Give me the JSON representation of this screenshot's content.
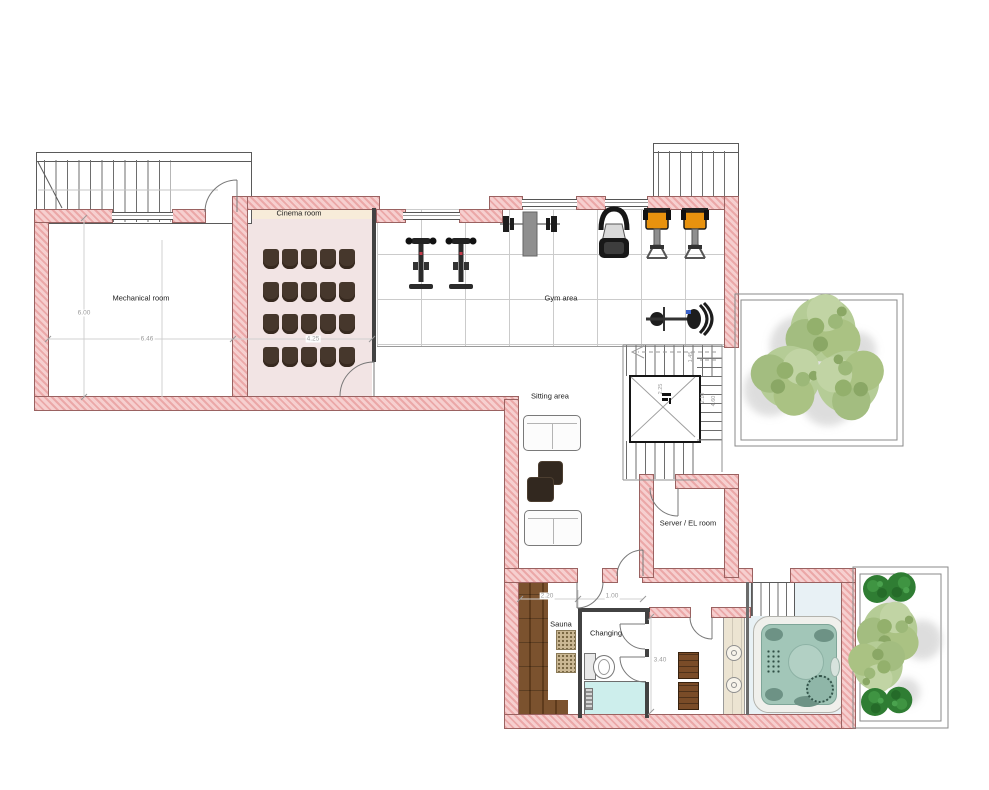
{
  "plan_type": "floor plan",
  "rooms": {
    "mechanical": {
      "label": "Mechanical room"
    },
    "cinema": {
      "label": "Cinema room"
    },
    "gym": {
      "label": "Gym area"
    },
    "sitting": {
      "label": "Sitting area"
    },
    "server_el": {
      "label": "Server / EL room"
    },
    "sauna": {
      "label": "Sauna"
    },
    "changing": {
      "label": "Changing"
    }
  },
  "dimensions": {
    "mechanical_height": "6.00",
    "mechanical_width": "6.46",
    "cinema_width": "4.25",
    "sauna_width": "2.20",
    "corridor_width": "1.00",
    "changing_depth": "3.40",
    "stair_run": "1.45",
    "elevator_width": "2.25",
    "stair_width": "2.10",
    "stairwell_depth": "4.60"
  },
  "cinema_seating": {
    "rows": 4,
    "cols": 5
  },
  "furniture_counts": {
    "sofas": 2,
    "ottomans": 2,
    "sauna_heaters": 2,
    "cabinets": 2
  },
  "gym_equipment": [
    "spin bike",
    "spin bike",
    "bench press",
    "cardio machine",
    "weight bench",
    "weight bench",
    "exercise bike"
  ],
  "features": [
    "elevator",
    "staircases",
    "hot tub",
    "toilet",
    "shower",
    "courtyard trees",
    "planter trees"
  ],
  "colors": {
    "wall_fill": "#f6cfcf",
    "wall_hatch": "#eba8a8",
    "cinema_floor": "#f2e4e4",
    "cinema_accent_strip": "#f7ecd9",
    "seat_brown": "#46372c",
    "sauna_wood": "#7b522e",
    "shower_blue": "#cdeeec",
    "hot_tub_teal": "#a2c6b8",
    "hot_tub_floor": "#e8f1f5",
    "tree_light_green": "#b5cc96",
    "tree_dark_green": "#2f7d33",
    "machine_orange": "#e8920e",
    "dimension_gray": "#9b9b9b"
  }
}
